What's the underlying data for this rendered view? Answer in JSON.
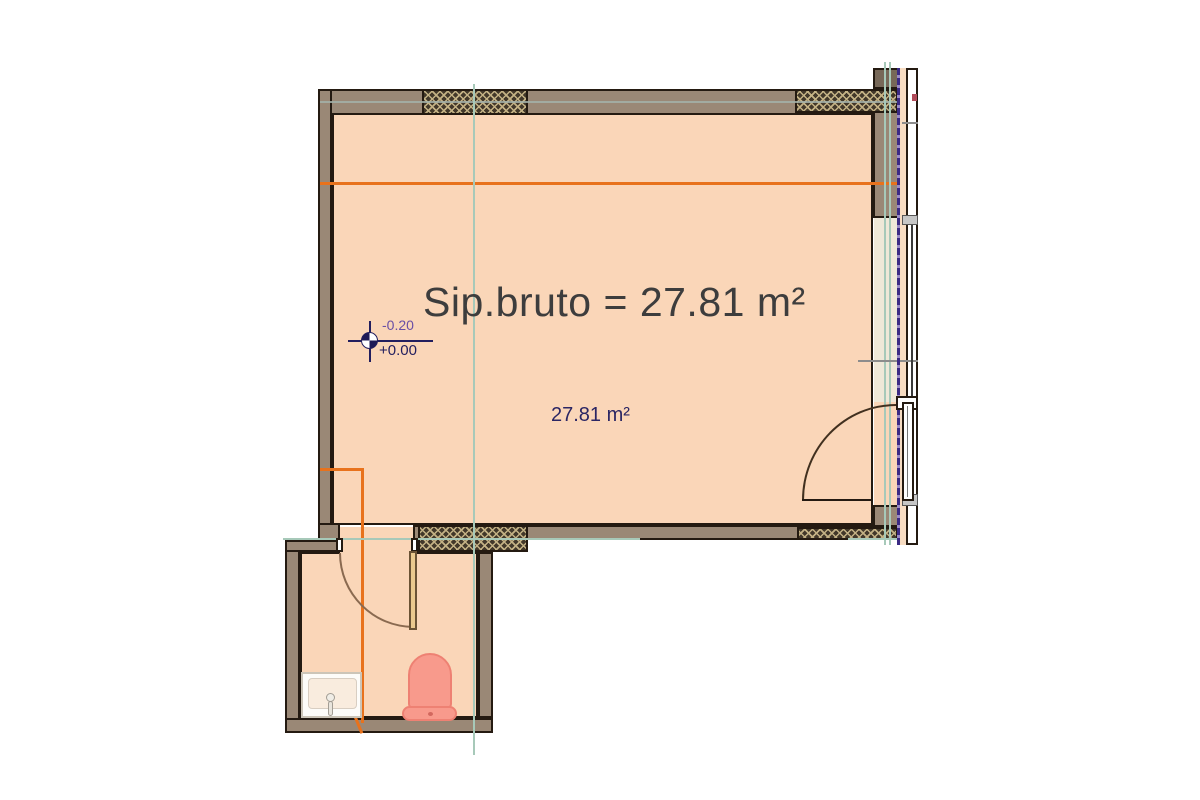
{
  "drawing": {
    "type": "architectural-floor-plan",
    "room_title": "Sip.bruto = 27.81 m²",
    "room_area_label": "27.81 m²",
    "level_marker": {
      "upper": "-0.20",
      "lower": "+0.00"
    },
    "rooms": [
      {
        "name": "main-room",
        "gross_area_m2": 27.81
      },
      {
        "name": "bathroom"
      }
    ],
    "fixtures": [
      "toilet",
      "sink"
    ],
    "openings": [
      "balcony-door-right",
      "window-right",
      "bathroom-door"
    ],
    "colors": {
      "background": "#ffffff",
      "room_fill": "#fad6b8",
      "wall_fill": "#9a8876",
      "wall_outline": "#241a11",
      "insulation_hatch_bg": "#42382a",
      "insulation_hatch_line": "#c3b184",
      "section_line_orange": "#e8721c",
      "grid_line_teal": "#a7c9b9",
      "railing_line_purple": "#3b2a84",
      "fixture_pink": "#f89a8c",
      "title_text": "#3d3d3d",
      "area_text": "#2b2664",
      "level_upper_text": "#6a4fa5",
      "level_lower_text": "#221e5e"
    }
  }
}
